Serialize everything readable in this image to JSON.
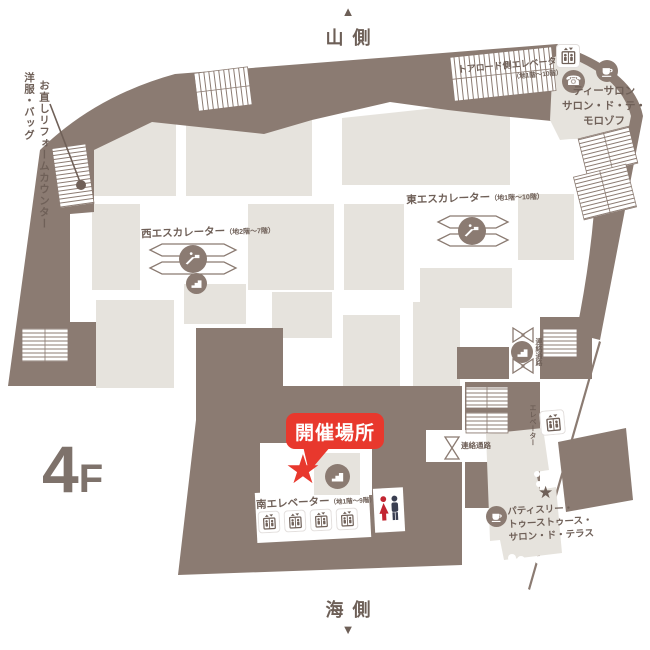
{
  "floor_map": {
    "floor_label": {
      "number": "4",
      "suffix": "F"
    },
    "compass": {
      "top": "山側",
      "bottom": "海側",
      "up_arrow": "▲",
      "down_arrow": "▼"
    },
    "event_callout": {
      "label": "開催場所",
      "star": "★"
    },
    "facilities": {
      "west_escalator": {
        "label": "西エスカレーター",
        "floors": "（地2階～7階）"
      },
      "east_escalator": {
        "label": "東エスカレーター",
        "floors": "（地1階～10階）"
      },
      "south_elevator": {
        "label": "南エレベーター",
        "floors": "（地1階～9階）"
      },
      "toa_road_elevator": {
        "label": "トアロード側エレベーター",
        "floors": "（地1階～10階）"
      },
      "side_elevator": {
        "label": "エレベーター"
      },
      "passage_right": {
        "label": "連絡通路"
      },
      "passage_center": {
        "label": "連絡通路"
      }
    },
    "shops": {
      "tea_salon": {
        "lines": [
          "ティーサロン",
          "サロン・ド・テ・",
          "モロゾフ"
        ]
      },
      "patisserie": {
        "lines": [
          "パティスリー・",
          "トゥーストゥース・",
          "サロン・ド・テラス"
        ],
        "star": "★"
      },
      "repair_counter": {
        "lines": [
          "洋服・バッグ",
          "お直しリフォームカウンター"
        ]
      }
    },
    "colors": {
      "map_dark": "#8b7b72",
      "map_light": "#e6e3dd",
      "accent_red": "#e8382d",
      "text_brown": "#6f6058"
    }
  }
}
